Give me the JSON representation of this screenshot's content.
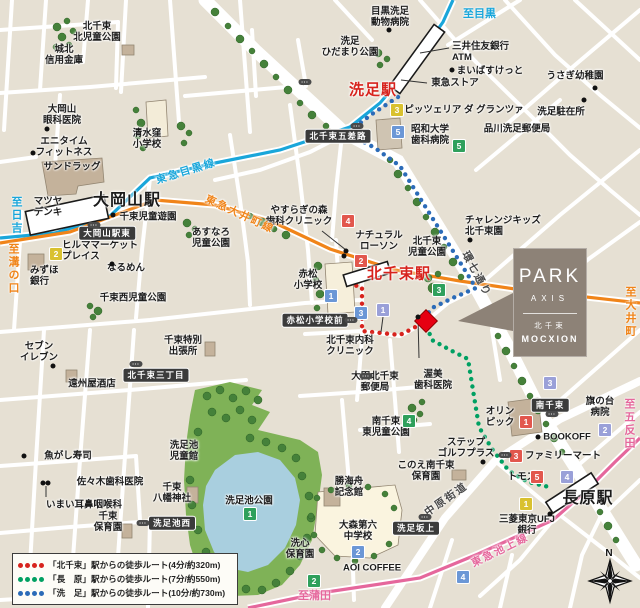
{
  "palette": {
    "land": "#e6e0d3",
    "road": "#ffffff",
    "park": "#7fb257",
    "tree": "#45813a",
    "pond": "#a9cfdf",
    "line_meguro": "#19a6da",
    "line_oimachi": "#f08419",
    "line_ikegami": "#e5679c",
    "route_kitasenzoku": "#d7231d",
    "route_nagahara": "#00a062",
    "route_senzoku": "#2b6bb8",
    "badge_yellow": "#d9c12f",
    "badge_green": "#2fa05c",
    "badge_blue": "#6b97d6",
    "badge_lavender": "#9aa0d8",
    "badge_red": "#e2574d",
    "property_marker": "#e60012",
    "park_box_bg": "#8d8277",
    "dark_badge_bg": "#3b3b3b"
  },
  "park_box": {
    "brand": "PARK",
    "series": "AXIS",
    "location": "北千束",
    "name": "MOCXION"
  },
  "compass": {
    "north": "N"
  },
  "legend": {
    "items": [
      {
        "color": "#d7231d",
        "label": "「北千束」駅からの徒歩ルート(4分/約320m)"
      },
      {
        "color": "#00a062",
        "label": "「長　原」駅からの徒歩ルート(7分/約550m)"
      },
      {
        "color": "#2b6bb8",
        "label": "「洗　足」駅からの徒歩ルート(10分/約730m)"
      }
    ]
  },
  "stations": [
    {
      "name": "大岡山駅",
      "x": 127,
      "y": 198,
      "size": 16,
      "color": "#1a1a1a"
    },
    {
      "name": "洗足駅",
      "x": 373,
      "y": 89,
      "size": 15,
      "color": "#d7231d"
    },
    {
      "name": "北千束駅",
      "x": 399,
      "y": 273,
      "size": 15,
      "color": "#d7231d"
    },
    {
      "name": "長原駅",
      "x": 588,
      "y": 496,
      "size": 16,
      "color": "#1a1a1a"
    }
  ],
  "direction_labels": [
    {
      "text": "至目黒",
      "x": 463,
      "y": 5,
      "color": "#19a6da",
      "vertical": false
    },
    {
      "text": "至日吉",
      "x": 8,
      "y": 196,
      "color": "#19a6da",
      "vertical": true
    },
    {
      "text": "至溝の口",
      "x": 5,
      "y": 243,
      "color": "#f08419",
      "vertical": true
    },
    {
      "text": "至大井町",
      "x": 622,
      "y": 286,
      "color": "#f08419",
      "vertical": true
    },
    {
      "text": "至五反田",
      "x": 621,
      "y": 398,
      "color": "#e5679c",
      "vertical": true
    },
    {
      "text": "至蒲田",
      "x": 298,
      "y": 587,
      "color": "#e5679c",
      "vertical": false
    }
  ],
  "line_labels": [
    {
      "text": "東急目黒線",
      "x": 186,
      "y": 171,
      "color": "#19a6da",
      "rotate": -17
    },
    {
      "text": "東急大井町線",
      "x": 240,
      "y": 214,
      "color": "#f08419",
      "rotate": 25
    },
    {
      "text": "東急池上線",
      "x": 500,
      "y": 550,
      "color": "#e5679c",
      "rotate": -26
    },
    {
      "text": "環七通り",
      "x": 477,
      "y": 274,
      "color": "#4a4a4a",
      "rotate": 62
    },
    {
      "text": "中原街道",
      "x": 446,
      "y": 499,
      "color": "#4a4a4a",
      "rotate": -35
    }
  ],
  "poi_labels": [
    {
      "text": "北千束\n北児童公園",
      "x": 97,
      "y": 32
    },
    {
      "text": "城北\n信用金庫",
      "x": 64,
      "y": 55
    },
    {
      "text": "大岡山\n眼科医院",
      "x": 62,
      "y": 115
    },
    {
      "text": "エニタイム\nフィットネス",
      "x": 64,
      "y": 147
    },
    {
      "text": "サンドラッグ",
      "x": 72,
      "y": 167
    },
    {
      "text": "マツヤ\nデンキ",
      "x": 48,
      "y": 207
    },
    {
      "text": "清水窪\n小学校",
      "x": 147,
      "y": 139
    },
    {
      "text": "千束児童遊園",
      "x": 148,
      "y": 217
    },
    {
      "text": "ヒルママーケット\nプレイス",
      "x": 62,
      "y": 251,
      "align": "left"
    },
    {
      "text": "みずほ\n銀行",
      "x": 30,
      "y": 276,
      "align": "left"
    },
    {
      "text": "なるめん",
      "x": 126,
      "y": 268
    },
    {
      "text": "あすなろ\n児童公園",
      "x": 211,
      "y": 238
    },
    {
      "text": "千束西児童公園",
      "x": 133,
      "y": 298
    },
    {
      "text": "セブン\nイレブン",
      "x": 39,
      "y": 352
    },
    {
      "text": "遠州屋酒店",
      "x": 92,
      "y": 384
    },
    {
      "text": "千束特別\n出張所",
      "x": 183,
      "y": 346
    },
    {
      "text": "魚がし寿司",
      "x": 68,
      "y": 456
    },
    {
      "text": "佐々木歯科医院",
      "x": 110,
      "y": 482
    },
    {
      "text": "いまい耳鼻咽喉科",
      "x": 84,
      "y": 505
    },
    {
      "text": "千束\n保育園",
      "x": 108,
      "y": 522
    },
    {
      "text": "洗足池\n児童館",
      "x": 184,
      "y": 451
    },
    {
      "text": "千束\n八幡神社",
      "x": 172,
      "y": 493
    },
    {
      "text": "洗足池公園",
      "x": 249,
      "y": 501
    },
    {
      "text": "目黒洗足\n動物病院",
      "x": 390,
      "y": 17
    },
    {
      "text": "洗足\nひだまり公園",
      "x": 350,
      "y": 47
    },
    {
      "text": "三井住友銀行\nATM",
      "x": 452,
      "y": 52,
      "align": "left"
    },
    {
      "text": "まいばすけっと",
      "x": 490,
      "y": 71
    },
    {
      "text": "東急ストア",
      "x": 455,
      "y": 83
    },
    {
      "text": "うさぎ幼稚園",
      "x": 575,
      "y": 76
    },
    {
      "text": "ピッツェリア ダ グランツァ",
      "x": 464,
      "y": 110
    },
    {
      "text": "洗足駐在所",
      "x": 561,
      "y": 112
    },
    {
      "text": "品川洗足郵便局",
      "x": 517,
      "y": 129
    },
    {
      "text": "昭和大学\n歯科病院",
      "x": 430,
      "y": 135
    },
    {
      "text": "やすらぎの森\n歯科クリニック",
      "x": 299,
      "y": 216
    },
    {
      "text": "ナチュラル\nローソン",
      "x": 379,
      "y": 241
    },
    {
      "text": "北千束\n児童公園",
      "x": 427,
      "y": 247
    },
    {
      "text": "チャレンジキッズ\n北千束園",
      "x": 465,
      "y": 226,
      "align": "left"
    },
    {
      "text": "赤松\n小学校",
      "x": 308,
      "y": 280
    },
    {
      "text": "北千束内科\nクリニック",
      "x": 350,
      "y": 346
    },
    {
      "text": "大田北千束\n郵便局",
      "x": 375,
      "y": 382
    },
    {
      "text": "渥美\n歯科医院",
      "x": 433,
      "y": 380
    },
    {
      "text": "南千束\n東児童公園",
      "x": 386,
      "y": 427
    },
    {
      "text": "このえ南千束\n保育園",
      "x": 426,
      "y": 471
    },
    {
      "text": "ステップ\nゴルフプラス",
      "x": 466,
      "y": 448
    },
    {
      "text": "オリン\nピック",
      "x": 500,
      "y": 417
    },
    {
      "text": "旗の台\n病院",
      "x": 600,
      "y": 407
    },
    {
      "text": "BOOKOFF",
      "x": 567,
      "y": 437
    },
    {
      "text": "ファミリーマート",
      "x": 563,
      "y": 456
    },
    {
      "text": "トモズ",
      "x": 522,
      "y": 477
    },
    {
      "text": "三菱東京UFJ\n銀行",
      "x": 527,
      "y": 525
    },
    {
      "text": "勝海舟\n記念館",
      "x": 349,
      "y": 487
    },
    {
      "text": "大森第六\n中学校",
      "x": 358,
      "y": 531
    },
    {
      "text": "洗心\n保育園",
      "x": 300,
      "y": 549
    },
    {
      "text": "AOI COFFEE",
      "x": 372,
      "y": 568
    }
  ],
  "dark_badges": [
    {
      "text": "大岡山駅東",
      "x": 107,
      "y": 233
    },
    {
      "text": "北千束五差路",
      "x": 338,
      "y": 136
    },
    {
      "text": "北千束三丁目",
      "x": 156,
      "y": 375
    },
    {
      "text": "赤松小学校前",
      "x": 315,
      "y": 320
    },
    {
      "text": "洗足池西",
      "x": 172,
      "y": 523
    },
    {
      "text": "洗足坂上",
      "x": 416,
      "y": 528
    },
    {
      "text": "南千束",
      "x": 550,
      "y": 405
    }
  ],
  "number_badges": [
    {
      "n": "1",
      "color": "yellow",
      "x": 526,
      "y": 504
    },
    {
      "n": "2",
      "color": "yellow",
      "x": 56,
      "y": 254
    },
    {
      "n": "3",
      "color": "yellow",
      "x": 397,
      "y": 110
    },
    {
      "n": "1",
      "color": "green",
      "x": 250,
      "y": 514
    },
    {
      "n": "2",
      "color": "green",
      "x": 314,
      "y": 581
    },
    {
      "n": "3",
      "color": "green",
      "x": 439,
      "y": 290
    },
    {
      "n": "4",
      "color": "green",
      "x": 409,
      "y": 421
    },
    {
      "n": "5",
      "color": "green",
      "x": 459,
      "y": 146
    },
    {
      "n": "1",
      "color": "blue",
      "x": 331,
      "y": 296
    },
    {
      "n": "2",
      "color": "blue",
      "x": 358,
      "y": 552
    },
    {
      "n": "3",
      "color": "blue",
      "x": 361,
      "y": 313
    },
    {
      "n": "4",
      "color": "blue",
      "x": 463,
      "y": 577
    },
    {
      "n": "5",
      "color": "blue",
      "x": 398,
      "y": 132
    },
    {
      "n": "1",
      "color": "lavender",
      "x": 383,
      "y": 310
    },
    {
      "n": "2",
      "color": "lavender",
      "x": 605,
      "y": 430
    },
    {
      "n": "3",
      "color": "lavender",
      "x": 550,
      "y": 383
    },
    {
      "n": "4",
      "color": "lavender",
      "x": 567,
      "y": 477
    },
    {
      "n": "1",
      "color": "red",
      "x": 526,
      "y": 422
    },
    {
      "n": "2",
      "color": "red",
      "x": 361,
      "y": 261
    },
    {
      "n": "3",
      "color": "red",
      "x": 516,
      "y": 456
    },
    {
      "n": "4",
      "color": "red",
      "x": 348,
      "y": 221
    },
    {
      "n": "5",
      "color": "red",
      "x": 537,
      "y": 477
    }
  ],
  "bus_stops": [
    {
      "x": 94,
      "y": 225
    },
    {
      "x": 357,
      "y": 126
    },
    {
      "x": 351,
      "y": 320
    },
    {
      "x": 136,
      "y": 364
    },
    {
      "x": 143,
      "y": 523
    },
    {
      "x": 425,
      "y": 517
    },
    {
      "x": 552,
      "y": 414
    },
    {
      "x": 505,
      "y": 455
    },
    {
      "x": 366,
      "y": 376
    },
    {
      "x": 305,
      "y": 82
    }
  ],
  "poi_dots": [
    {
      "x": 389,
      "y": 30
    },
    {
      "x": 452,
      "y": 70
    },
    {
      "x": 595,
      "y": 88
    },
    {
      "x": 584,
      "y": 100
    },
    {
      "x": 47,
      "y": 129
    },
    {
      "x": 33,
      "y": 153
    },
    {
      "x": 113,
      "y": 215
    },
    {
      "x": 112,
      "y": 264
    },
    {
      "x": 53,
      "y": 366
    },
    {
      "x": 24,
      "y": 456
    },
    {
      "x": 43,
      "y": 483
    },
    {
      "x": 48,
      "y": 483
    },
    {
      "x": 346,
      "y": 251
    },
    {
      "x": 344,
      "y": 256
    },
    {
      "x": 470,
      "y": 240
    },
    {
      "x": 483,
      "y": 462
    },
    {
      "x": 538,
      "y": 437
    },
    {
      "x": 550,
      "y": 514
    },
    {
      "x": 418,
      "y": 317
    }
  ]
}
